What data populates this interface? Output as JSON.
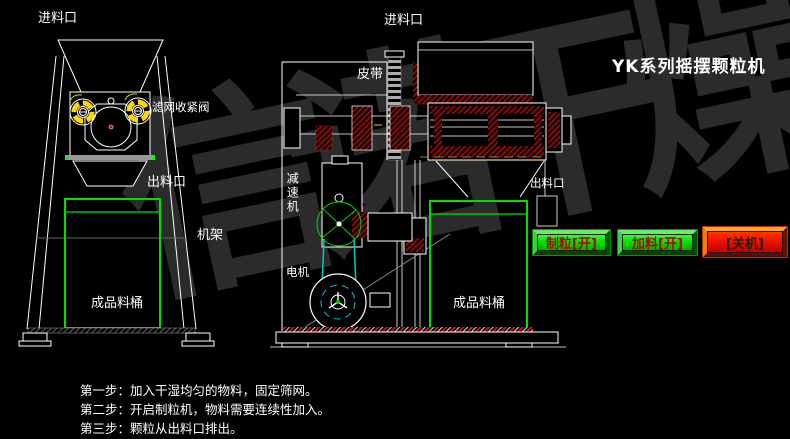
{
  "title": "YK系列摇摆颗粒机",
  "watermark": "信诺干燥",
  "front_view": {
    "labels": {
      "inlet": "进料口",
      "filter_valve": "滤网收紧阀",
      "outlet": "出料口",
      "frame": "机架",
      "barrel": "成品料桶"
    }
  },
  "side_view": {
    "labels": {
      "inlet": "进料口",
      "belt": "皮带",
      "reducer": "减速机",
      "motor": "电机",
      "outlet": "出料口",
      "barrel": "成品料桶"
    }
  },
  "controls": {
    "granulate": {
      "label": "制粒[开]",
      "face_color": "#00dd00",
      "text_color": "#b30000"
    },
    "feed": {
      "label": "加料[开]",
      "face_color": "#00dd00",
      "text_color": "#b30000"
    },
    "shutdown": {
      "label": "[关机]",
      "face_color": "#ee1100",
      "text_color": "#1c1c00"
    }
  },
  "instructions": {
    "step1": "第一步：加入干湿均匀的物料，固定筛网。",
    "step2": "第二步：开启制粒机，物料需要连续性加入。",
    "step3": "第三步：颗粒从出料口排出。"
  },
  "colors": {
    "background": "#000000",
    "line_white": "#ffffff",
    "barrel_green": "#00e000",
    "hatch_red": "#cc1111",
    "belt_cyan": "#00cccc",
    "wheel_yellow": "#ffd700",
    "watermark_gray": "#2b2b2b"
  }
}
